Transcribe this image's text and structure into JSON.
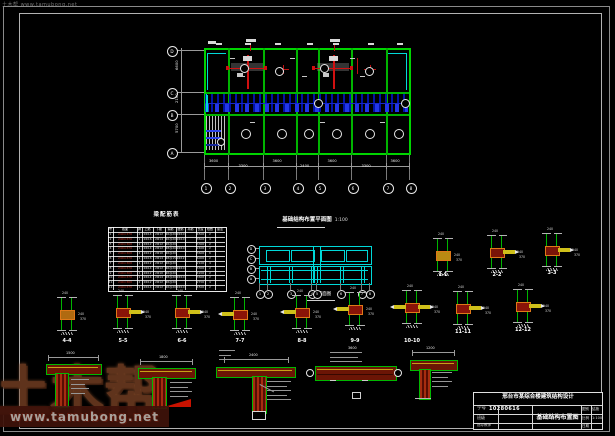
{
  "watermark": {
    "brand": "土木帮",
    "url": "www.tamubong.net",
    "corner": "土木帮 www.tamubong.net"
  },
  "top_plan": {
    "axes_bottom": [
      "1",
      "2",
      "3",
      "4",
      "5",
      "6",
      "7",
      "8"
    ],
    "axes_left": [
      "D",
      "C",
      "B",
      "A"
    ],
    "dims_bottom": [
      "3600",
      "3300",
      "3600",
      "2400",
      "3600",
      "3300",
      "3600"
    ],
    "dims_left": [
      "6600",
      "2100",
      "5700"
    ]
  },
  "schedule_table": {
    "title": "梁配筋表",
    "headers": [
      "号",
      "截面",
      "跨",
      "上筋",
      "下筋",
      "箍筋",
      "腰筋",
      "吊筋",
      "长度",
      "根数",
      "备注"
    ],
    "rows": [
      [
        "1",
        "240×370",
        "2",
        "2Φ14",
        "2Φ12",
        "Φ6@200",
        "2Φ10",
        "",
        "4500",
        "2",
        ""
      ],
      [
        "2",
        "240×370",
        "1",
        "2Φ16",
        "2Φ14",
        "Φ6@200",
        "2Φ10",
        "",
        "3600",
        "4",
        ""
      ],
      [
        "3",
        "240×300",
        "2",
        "2Φ12",
        "2Φ12",
        "Φ6@200",
        "",
        "",
        "3300",
        "2",
        ""
      ],
      [
        "4",
        "240×370",
        "1",
        "2Φ14",
        "2Φ12",
        "Φ8@200",
        "2Φ10",
        "",
        "2400",
        "2",
        ""
      ],
      [
        "5",
        "240×300",
        "2",
        "2Φ12",
        "2Φ10",
        "Φ6@200",
        "",
        "",
        "3600",
        "6",
        ""
      ],
      [
        "6",
        "240×370",
        "1",
        "2Φ16",
        "2Φ14",
        "Φ8@150",
        "2Φ12",
        "",
        "6000",
        "2",
        ""
      ],
      [
        "7",
        "240×300",
        "1",
        "2Φ12",
        "2Φ12",
        "Φ6@200",
        "",
        "",
        "2100",
        "4",
        ""
      ],
      [
        "8",
        "240×370",
        "2",
        "2Φ14",
        "2Φ12",
        "Φ6@200",
        "2Φ10",
        "",
        "3300",
        "2",
        ""
      ],
      [
        "9",
        "240×300",
        "1",
        "2Φ12",
        "2Φ10",
        "Φ6@200",
        "",
        "",
        "4200",
        "2",
        ""
      ],
      [
        "10",
        "240×370",
        "1",
        "2Φ14",
        "2Φ14",
        "Φ8@200",
        "2Φ10",
        "",
        "3600",
        "2",
        ""
      ],
      [
        "11",
        "240×300",
        "2",
        "2Φ12",
        "2Φ12",
        "Φ6@200",
        "",
        "",
        "2700",
        "4",
        ""
      ],
      [
        "12",
        "240×370",
        "1",
        "2Φ14",
        "2Φ12",
        "Φ6@200",
        "2Φ10",
        "",
        "4500",
        "2",
        ""
      ]
    ]
  },
  "foundation_plan": {
    "title": "基础结构布置平面图",
    "scale": "1:100",
    "caption": "基础平面图",
    "axes_bottom": [
      "1",
      "2",
      "3",
      "4",
      "5",
      "6",
      "7",
      "8"
    ],
    "axes_left": [
      "D",
      "C",
      "B",
      "A"
    ]
  },
  "details": {
    "items": [
      {
        "id": "1-1",
        "x": 443,
        "y": 255,
        "ly": 273,
        "v": "plain",
        "fill": "#b98a12",
        "dims": [
          "240",
          "370"
        ],
        "top": "240"
      },
      {
        "id": "2-2",
        "x": 497,
        "y": 252,
        "ly": 273,
        "v": "stub-r",
        "fill": "#7a1408",
        "dims": [
          "240",
          "370"
        ],
        "top": "240"
      },
      {
        "id": "3-3",
        "x": 552,
        "y": 250,
        "ly": 271,
        "v": "stub-r",
        "fill": "#7a1408",
        "dims": [
          "240",
          "370"
        ],
        "top": "240"
      },
      {
        "id": "4-4",
        "x": 67,
        "y": 314,
        "ly": 339,
        "v": "plain",
        "fill": "#b06a10",
        "dims": [
          "240",
          "370"
        ],
        "top": "240"
      },
      {
        "id": "5-5",
        "x": 123,
        "y": 312,
        "ly": 339,
        "v": "stub-r",
        "fill": "#8a1408",
        "dims": [
          "240",
          "370"
        ],
        "top": "240"
      },
      {
        "id": "6-6",
        "x": 182,
        "y": 312,
        "ly": 339,
        "v": "stub-r",
        "fill": "#8a1408",
        "dims": [
          "240",
          "370"
        ],
        "top": "240"
      },
      {
        "id": "7-7",
        "x": 240,
        "y": 314,
        "ly": 339,
        "v": "stub-l",
        "fill": "#8a1408",
        "dims": [
          "240",
          "370"
        ],
        "top": "240"
      },
      {
        "id": "8-8",
        "x": 302,
        "y": 312,
        "ly": 339,
        "v": "stub-l",
        "fill": "#8a1408",
        "dims": [
          "240",
          "370"
        ],
        "top": "240"
      },
      {
        "id": "9-9",
        "x": 355,
        "y": 309,
        "ly": 339,
        "v": "stub-l",
        "fill": "#8a1408",
        "dims": [
          "240",
          "370"
        ],
        "top": "240"
      },
      {
        "id": "10-10",
        "x": 412,
        "y": 307,
        "ly": 339,
        "v": "bar",
        "fill": "#8a1408",
        "dims": [
          "240",
          "370"
        ],
        "top": "240"
      },
      {
        "id": "11-11",
        "x": 463,
        "y": 308,
        "ly": 330,
        "v": "stub-r",
        "fill": "#8a1408",
        "dims": [
          "240",
          "370"
        ],
        "top": "240"
      },
      {
        "id": "12-12",
        "x": 523,
        "y": 306,
        "ly": 328,
        "v": "stub-r",
        "fill": "#8a1408",
        "dims": [
          "240",
          "370"
        ],
        "top": "240"
      }
    ]
  },
  "big_details": {
    "dims": [
      "1500",
      "1800",
      "2400",
      "3600",
      "1200"
    ]
  },
  "title_block": {
    "project": "邢台市某综合楼建筑结构设计",
    "student_label": "学号",
    "student_no": "10280616",
    "class_label": "班级",
    "class_value": "",
    "advisor_label": "指导教师",
    "advisor_value": "",
    "drawing_title": "基础结构布置图",
    "mini": [
      {
        "label": "图别",
        "value": "结施"
      },
      {
        "label": "比例",
        "value": "1:100"
      },
      {
        "label": "日期",
        "value": ""
      }
    ]
  }
}
